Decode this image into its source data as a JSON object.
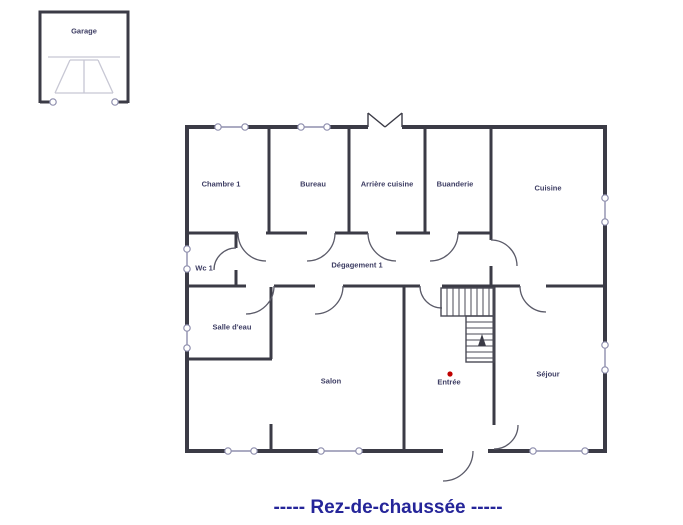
{
  "title": "-----  Rez-de-chaussée  -----",
  "garage": {
    "label": "Garage"
  },
  "rooms": [
    {
      "id": "chambre-1",
      "label": "Chambre 1"
    },
    {
      "id": "bureau",
      "label": "Bureau"
    },
    {
      "id": "arriere-cuisine",
      "label": "Arrière cuisine"
    },
    {
      "id": "buanderie",
      "label": "Buanderie"
    },
    {
      "id": "cuisine",
      "label": "Cuisine"
    },
    {
      "id": "degagement-1",
      "label": "Dégagement 1"
    },
    {
      "id": "wc-1",
      "label": "Wc 1"
    },
    {
      "id": "salle-d-eau",
      "label": "Salle d'eau"
    },
    {
      "id": "salon",
      "label": "Salon"
    },
    {
      "id": "entree",
      "label": "Entrée"
    },
    {
      "id": "sejour",
      "label": "Séjour"
    }
  ],
  "icons": {
    "staircase": "l-shaped-stairs",
    "garage_door": "up-and-over-door",
    "window": "double-circle-window",
    "entrance_marker": "red-dot"
  },
  "colors": {
    "wall": "#3b3b46",
    "room_label": "#3d3d63",
    "title": "#252599",
    "window": "#8f8fae",
    "door_arc": "#5a5a68",
    "marker": "#c00000",
    "garage_door": "#c7c7d4"
  }
}
